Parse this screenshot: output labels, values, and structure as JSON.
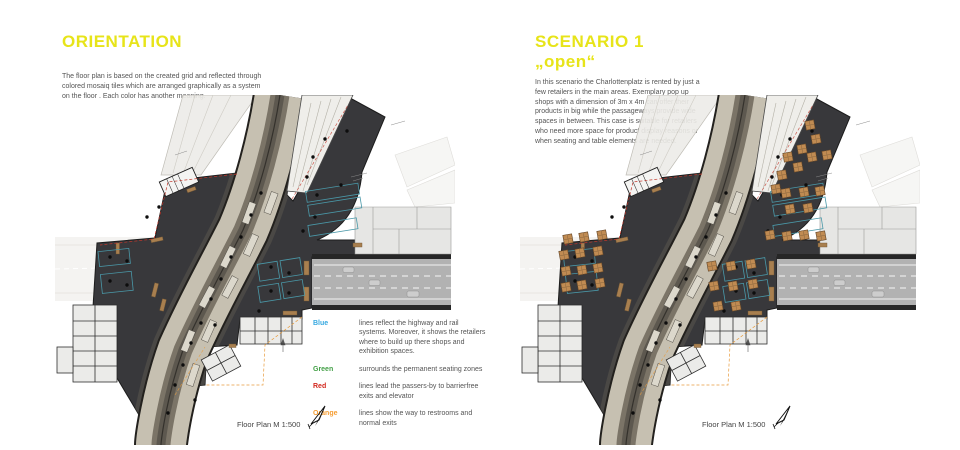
{
  "left_panel": {
    "title": "ORIENTATION",
    "description": "The floor plan is based on the created grid and reflected through colored mosaiq tiles which are arranged graphically as a system on the floor . Each color has another meaning.",
    "caption": "Floor Plan M 1:500"
  },
  "right_panel": {
    "title": "SCENARIO 1\n„open“",
    "description": "In this scenario the Charlottenplatz is rented by just a few retailers in the main areas. Exemplary pop up shops with a dimension of 3m x 4m can offer their products in big  while the passageways provide wide spaces in between. This case is suitable for retailers who need more space for product display reasons or when seating and table elements are needed.",
    "caption": "Floor Plan M 1:500"
  },
  "legend": {
    "items": [
      {
        "term": "Blue",
        "color": "#35a8e0",
        "text": "lines reflect the highway and rail systems. Moreover, it shows the retailers where to build up there shops and exhibition spaces."
      },
      {
        "term": "Green",
        "color": "#43a047",
        "text": "surrounds the permanent seating zones"
      },
      {
        "term": "Red",
        "color": "#d3281e",
        "text": "lines lead the passers-by to barrierfree exits and elevator"
      },
      {
        "term": "Orange",
        "color": "#f59d33",
        "text": "lines show the way to restrooms and normal exits"
      }
    ]
  },
  "theme": {
    "title_color": "#e7e419",
    "body_text_color": "#555555"
  },
  "plan_colors": {
    "dark_floor": "#38383b",
    "corridor": "#c6c0b1",
    "track": "#7b7467",
    "road": "#b2b2b2",
    "faded": "#edecE8",
    "teal_zone": "#4a98a8",
    "tan_wall": "#a87f4f",
    "popup_box": "#c08b52"
  }
}
